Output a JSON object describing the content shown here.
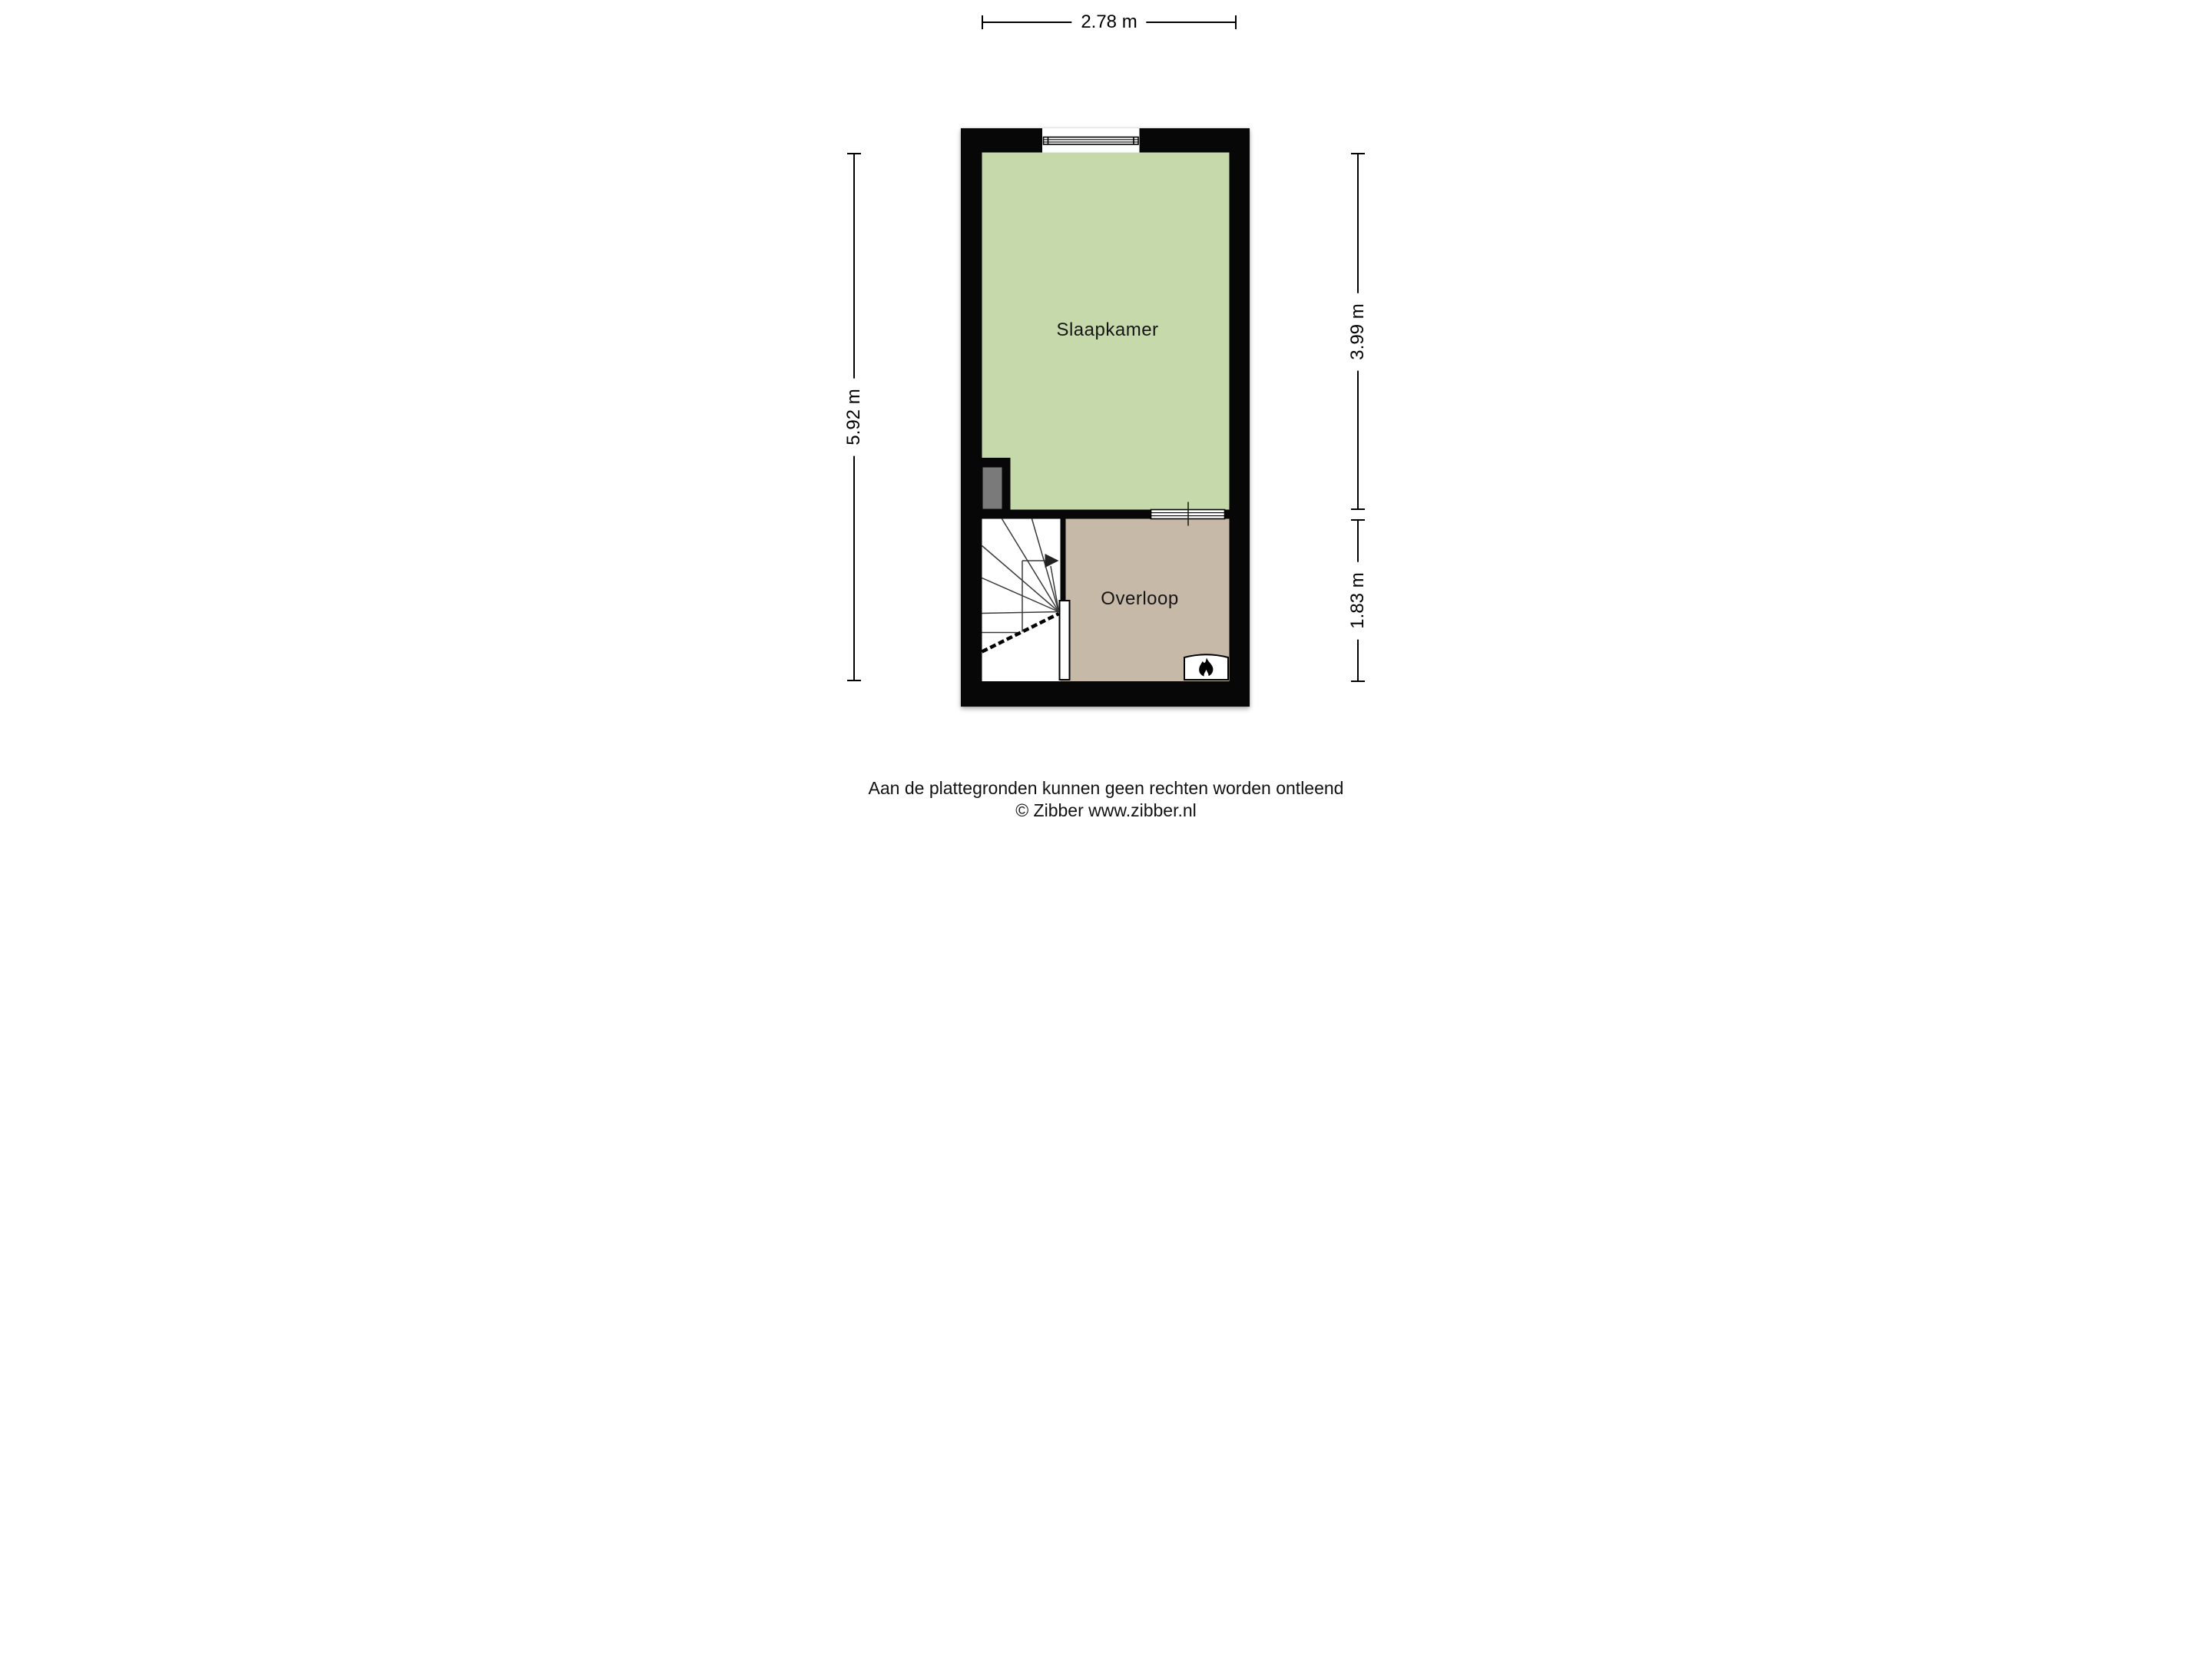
{
  "floorplan": {
    "rooms": {
      "bedroom": {
        "label": "Slaapkamer",
        "floor_color": "#c5d9ab"
      },
      "landing": {
        "label": "Overloop",
        "floor_color": "#c7b9a8"
      }
    },
    "wall_color": "#070707",
    "duct_color": "#7a7a7a",
    "stair_line_color": "#3a3a3a",
    "dimensions": {
      "top": "2.78 m",
      "left": "5.92 m",
      "right_upper": "3.99 m",
      "right_lower": "1.83 m"
    },
    "icons": {
      "flame": "flame-icon",
      "stair_arrow": "stair-direction-arrow",
      "window": "window-icon",
      "interior_window": "interior-window-icon"
    }
  },
  "footer": {
    "disclaimer": "Aan de plattegronden kunnen geen rechten worden ontleend",
    "credit": "© Zibber www.zibber.nl"
  }
}
